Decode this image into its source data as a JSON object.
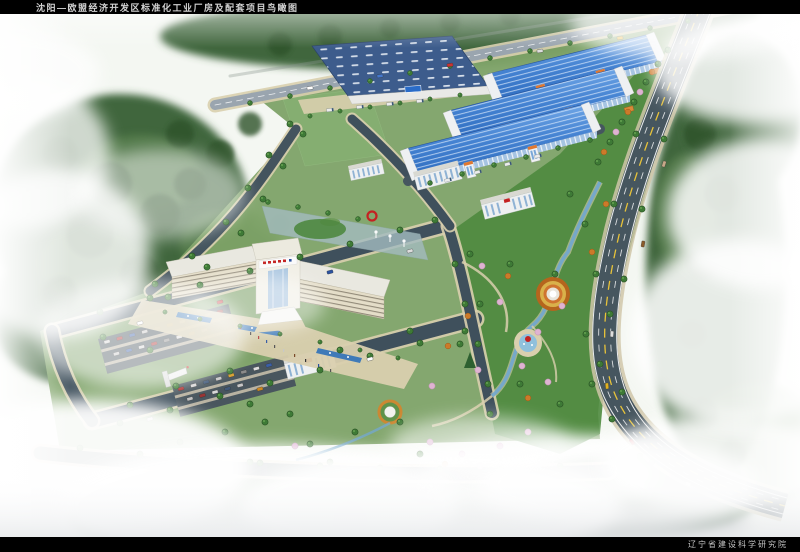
{
  "header": {
    "title": "沈阳—欧盟经济开发区标准化工业厂房及配套项目鸟瞰图"
  },
  "footer": {
    "credit": "辽宁省建设科学研究院"
  },
  "palette": {
    "bar-bg": "#000000",
    "bar-text": "#d2d2d2",
    "roof-blue-light": "#7db1ec",
    "roof-blue-deep": "#2f6dc0",
    "roof-navy": "#3d5c8c",
    "facade-glass": "#a6c4e2",
    "building-white": "#eef0f2",
    "building-cream": "#e4ddc8",
    "accent-orange": "#e07830",
    "sign-red": "#c42222",
    "road-dark": "#3f505c",
    "highway": "#46565f",
    "paving-tan": "#d9cfae",
    "lawn-green": "#7da267",
    "park-green": "#4e8a3e",
    "forest-green": "#41663c",
    "water-blue": "#74a8cc",
    "fog-white": "#ffffff"
  }
}
